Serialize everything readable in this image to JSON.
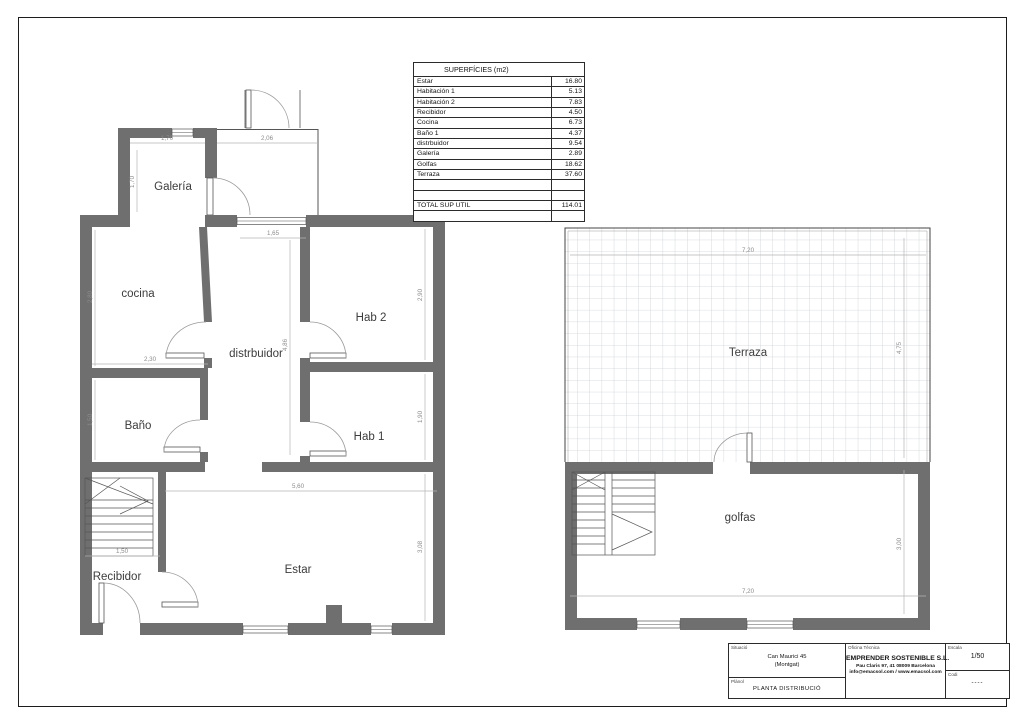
{
  "surfaces_table": {
    "title": "SUPERFÍCIES (m2)",
    "rows": [
      {
        "name": "Estar",
        "value": "16.80"
      },
      {
        "name": "Habitación 1",
        "value": "5.13"
      },
      {
        "name": "Habitación 2",
        "value": "7.83"
      },
      {
        "name": "Recibidor",
        "value": "4.50"
      },
      {
        "name": "Cocina",
        "value": "6.73"
      },
      {
        "name": "Baño 1",
        "value": "4.37"
      },
      {
        "name": "distrbuidor",
        "value": "9.54"
      },
      {
        "name": "Galería",
        "value": "2.89"
      },
      {
        "name": "Golfas",
        "value": "18.62"
      },
      {
        "name": "Terraza",
        "value": "37.60"
      },
      {
        "name": "",
        "value": ""
      },
      {
        "name": "",
        "value": ""
      },
      {
        "name": "TOTAL SUP UTIL",
        "value": "114.01"
      },
      {
        "name": "",
        "value": ""
      }
    ]
  },
  "ground_plan": {
    "rooms": {
      "galeria": "Galería",
      "cocina": "cocina",
      "distribuidor": "distrbuidor",
      "hab2": "Hab 2",
      "bano": "Baño",
      "hab1": "Hab 1",
      "recibidor": "Recibidor",
      "estar": "Estar"
    },
    "dims": {
      "galeria_w": "1,70",
      "galeria_h": "1,70",
      "porch_w": "2,06",
      "door_w": "1,65",
      "cocina_h": "2,80",
      "cocina_w": "2,30",
      "bano_h": "1,50",
      "distribuidor_h": "4,86",
      "hab2_h": "2,90",
      "hab1_h": "1,90",
      "estar_w": "5,60",
      "stairs_w": "1,50",
      "estar_h": "3,08"
    }
  },
  "upper_plan": {
    "rooms": {
      "terraza": "Terraza",
      "golfas": "golfas"
    },
    "dims": {
      "terraza_w": "7,20",
      "terraza_h": "4,75",
      "golfas_h": "3,00",
      "golfas_w": "7,20"
    }
  },
  "title_block": {
    "situacio_label": "Situació",
    "situacio_line1": "Can Maurici 45",
    "situacio_line2": "(Montgat)",
    "planol_label": "Plànol",
    "planol_value": "PLANTA DISTRIBUCIÓ",
    "office_label": "Oficina Tècnica",
    "office_name": "EMPRENDER SOSTENIBLE S.L.",
    "office_address": "Pau Claris 97, 41 08009 Barcelona",
    "office_web": "info@emacsol.com / www.emacsol.com",
    "escala_label": "Escala",
    "escala_value": "1/50",
    "codi_label": "Codi",
    "codi_value": "----"
  },
  "colors": {
    "wall": "#6f6f6f",
    "thin_line": "#555555",
    "dim_line": "#aaaaaa",
    "grid": "#ccd1d6"
  }
}
